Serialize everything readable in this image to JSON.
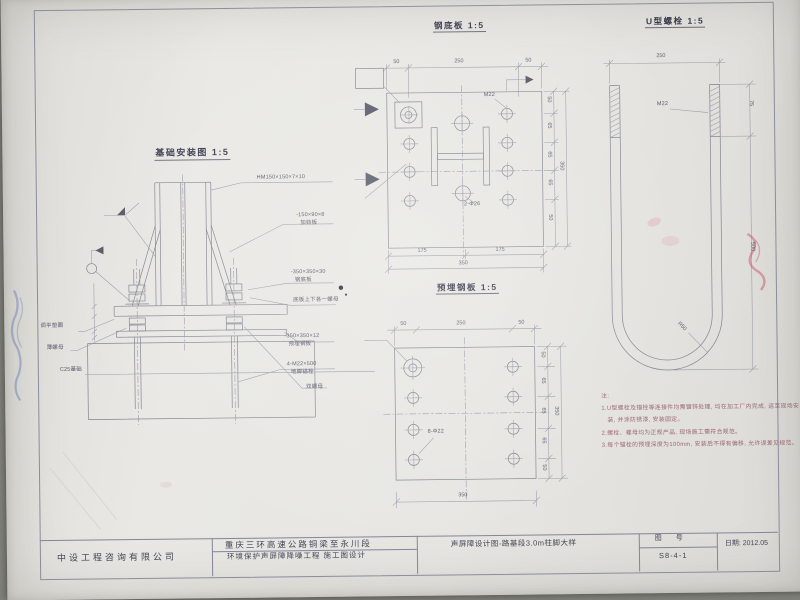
{
  "views": {
    "foundation": {
      "title": "基础安装图",
      "scale": "1:5",
      "callouts": {
        "column": "HM150×150×7×10",
        "stiffener_size": "-150×90×8",
        "stiffener_name": "加劲板",
        "baseplate_size": "-350×350×30",
        "baseplate_name": "钢底板",
        "nuts_note": "底板上下各一螺母",
        "embed_size": "-350×350×12",
        "embed_name": "预埋钢板",
        "anchor_size": "4-M22×500",
        "anchor_name": "地脚锚栓",
        "double_nut": "双螺母",
        "washer": "调平垫圈",
        "thin_nut": "薄螺母",
        "foundation_mat": "C25基础"
      }
    },
    "base_plate": {
      "title": "钢底板",
      "scale": "1:5",
      "dims": {
        "top": [
          "50",
          "250",
          "50"
        ],
        "bottom": [
          "175",
          "175"
        ],
        "bottom_total": "350",
        "right": [
          "50",
          "65",
          "65",
          "65",
          "50"
        ],
        "right_total": "350"
      },
      "callouts": {
        "hole_top": "M22",
        "hole_center": "2-Φ26"
      }
    },
    "embedded_plate": {
      "title": "预埋钢板",
      "scale": "1:5",
      "dims": {
        "top": [
          "50",
          "250",
          "50"
        ],
        "bottom_total": "350",
        "right": [
          "50",
          "65",
          "65",
          "65",
          "50"
        ],
        "right_total": "350"
      },
      "callouts": {
        "holes": "8-Φ22"
      }
    },
    "u_bolt": {
      "title": "U型螺栓",
      "scale": "1:5",
      "dims": {
        "width": "250",
        "thread_length": "75",
        "leg_length": "500",
        "bend_radius": "R50"
      },
      "callouts": {
        "thread": "M22"
      }
    }
  },
  "notes": {
    "heading": "注:",
    "lines": [
      "1.U型螺栓及锚栓等连接件均需镀锌处理, 均在加工厂内完成, 运至现场安",
      "装, 并涂防锈漆, 安装固定。",
      "2.螺栓、螺母均为正规产品, 现场施工需符合规范。",
      "3.每个锚栓的预埋深度为100mm, 安装后不得有偏移, 允许误差见规范。"
    ]
  },
  "title_block": {
    "company": "中设工程咨询有限公司",
    "project_line1": "重庆三环高速公路铜梁至永川段",
    "project_line2": "环境保护声屏障降噪工程 施工图设计",
    "drawing_title": "声屏障设计图-路基段3.0m柱脚大样",
    "sheet_label": "图 号",
    "sheet_no": "S8-4-1",
    "date": "日期: 2012.05"
  }
}
